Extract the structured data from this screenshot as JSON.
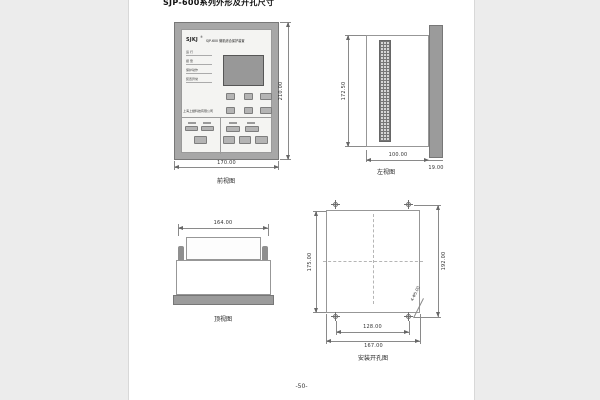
{
  "colors": {
    "panel_gray": "#a7a7a7",
    "face_gray": "#f4f4f2",
    "line_gray": "#8a8a8a"
  },
  "page": {
    "title": "SJP-600系列外形及开孔尺寸",
    "page_number": "-50-"
  },
  "front_view": {
    "caption": "前视图",
    "brand": "SJKJ",
    "brand_reg": "®",
    "device_title": "SJP-600 微机综合保护装置",
    "indicators": [
      "运 行",
      "报 警",
      "保护动作",
      "装置异常"
    ],
    "company": "上海上继科技有限公司",
    "dims": {
      "width": "170.00",
      "height": "210.00"
    }
  },
  "side_view": {
    "caption": "左视图",
    "dims": {
      "depth": "100.00",
      "panel_thickness": "19.00",
      "height": "172.50"
    }
  },
  "top_view": {
    "caption": "顶视图",
    "dims": {
      "width": "164.00"
    }
  },
  "cutout_view": {
    "caption": "安装开孔图",
    "dims": {
      "cutout_height": "175.00",
      "hole_spacing_v": "192.00",
      "hole_spacing_h": "128.00",
      "cutout_width": "167.00"
    },
    "hole_note": "4-Φ5.00"
  }
}
